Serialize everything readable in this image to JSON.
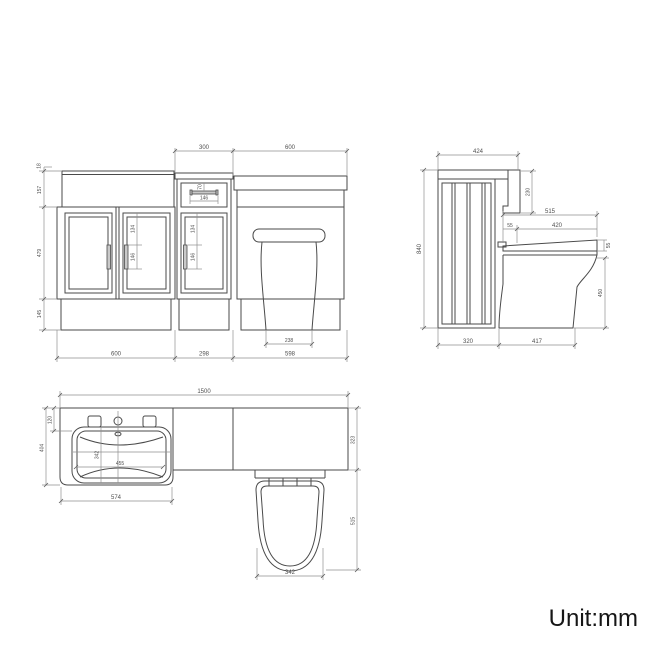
{
  "unit_note": "Unit:mm",
  "dims": {
    "front": {
      "top_mid_unit": "300",
      "top_wc_unit": "600",
      "lip": "18",
      "apron_height": "157",
      "door_height": "479",
      "plinth_height": "145",
      "handle_top_offset": "134",
      "handle_length": "146",
      "drawer_handle_offset": "70",
      "drawer_handle_length": "146",
      "pan_base_width": "238",
      "vanity_width": "600",
      "mid_unit_width": "298",
      "wc_unit_width": "598"
    },
    "side": {
      "top_depth": "424",
      "cistern_drop": "230",
      "seat_overall_depth": "515",
      "seat_setback": "55",
      "seat_length": "420",
      "overall_height": "840",
      "seat_thickness": "55",
      "pan_height": "450",
      "panel_depth": "320",
      "pan_projection": "417"
    },
    "plan": {
      "overall_width": "1500",
      "back_ledge_depth": "120",
      "left_unit_depth": "404",
      "basin_bowl_depth": "342",
      "basin_bowl_width": "455",
      "basin_unit_width": "574",
      "worktop_depth": "323",
      "pan_overall_length": "515",
      "pan_width": "342"
    }
  }
}
